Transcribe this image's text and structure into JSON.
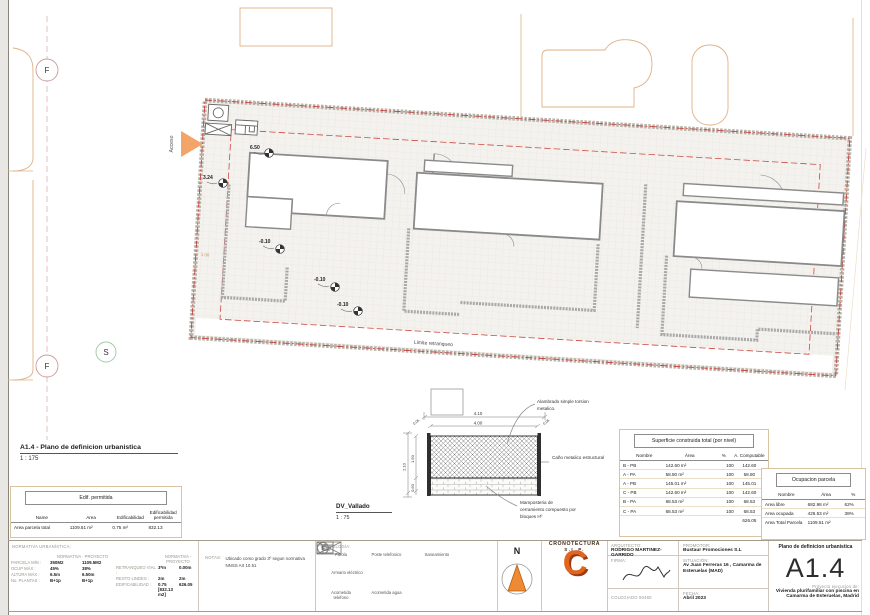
{
  "sheet": {
    "code": "A1.4",
    "plano_title": "Plano de definicion urbanistica",
    "proyecto_label": "Proyecto ejecucion de:",
    "proyecto_line1": "Vivienda plurifamiliar con piscina en",
    "proyecto_line2": "Camarma de Esteruelas, Madrid"
  },
  "view": {
    "title": "A1.4 - Plano de definicion urbanistica",
    "scale": "1 : 175"
  },
  "plan": {
    "marker_f": "F",
    "marker_f2": "F",
    "marker_s": "S",
    "acceso": "Acceso",
    "limite": "Limite retranqueo",
    "dim_left": "1.00",
    "levels": [
      "6.50",
      "3.24",
      "-0.10",
      "-0.10",
      "-0.10"
    ]
  },
  "vallado": {
    "title": "DV_Vallado",
    "scale": "1 : 75",
    "dim_total_w": "4.10",
    "dim_inner_w": "4.00",
    "dim_side_l": "0.05",
    "dim_side_r": "0.05",
    "dim_total_h": "2.10",
    "dim_mesh_h": "1.50",
    "dim_base_h": "0.60",
    "callout_mesh": "Alambrado simple torsion metalico.",
    "callout_post": "Caño metalico estructural",
    "callout_base": "Mamposteria de cerramiento compuesto por bloques Hº"
  },
  "edif_table": {
    "title": "Edif. permitida",
    "headers": [
      "Name",
      "Area",
      "Edificabilidad",
      "Edificabilidad permitida"
    ],
    "row": [
      "Area parcela total",
      "1109.51 m²",
      "0.75 m²",
      "832.13"
    ]
  },
  "superficie_table": {
    "title": "Superficie construida total (por nivel)",
    "headers": [
      "Nombre",
      "Área",
      "%",
      "A. Computable"
    ],
    "rows": [
      [
        "B - PB",
        "142.60 m²",
        "100",
        "142.60"
      ],
      [
        "A - PA",
        "58.80 m²",
        "100",
        "58.80"
      ],
      [
        "A - PB",
        "145.01 m²",
        "100",
        "145.01"
      ],
      [
        "C - PB",
        "142.60 m²",
        "100",
        "142.60"
      ],
      [
        "B - PA",
        "68.53 m²",
        "100",
        "68.53"
      ],
      [
        "C - PA",
        "68.53 m²",
        "100",
        "68.53"
      ]
    ],
    "total": "626.05"
  },
  "ocupacion_table": {
    "title": "Ocupacion parcela",
    "headers": [
      "Nombre",
      "Área",
      "%"
    ],
    "rows": [
      [
        "Area libre",
        "682.98 m²",
        "62%"
      ],
      [
        "Area ocupada",
        "426.53 m²",
        "38%"
      ],
      [
        "Area Total Parcela",
        "1109.51 m²",
        ""
      ]
    ]
  },
  "normativa": {
    "title": "NORMATIVA URBANÍSTICA:",
    "head_norm": "NORMATIVA",
    "head_sep": "-",
    "head_proy": "PROYECTO",
    "left": [
      {
        "label": "PARCELA MÍN :",
        "norm": "350M2",
        "proy": "1109.5M2"
      },
      {
        "label": "OCUP MÁX :",
        "norm": "45%",
        "proy": "38%"
      },
      {
        "label": "ALTURA MÁX :",
        "norm": "6.5m",
        "proy": "6.50m"
      },
      {
        "label": "No. PLANTAS :",
        "norm": "B+1p",
        "proy": "B+1p"
      }
    ],
    "right": [
      {
        "label": "RETRANQUEO VIAL :",
        "norm": "3*m",
        "proy": "0.00m"
      },
      {
        "label": "RESTO LINDES :",
        "norm": "2m",
        "proy": "2m"
      },
      {
        "label": "EDIFICABILIDAD :",
        "norm": "0.75 [832.13 m2]",
        "proy": "626.05"
      }
    ]
  },
  "notas": {
    "label": "NOTAS:",
    "text": "Ubicado como grado 3º segun normativa NNSS  Art 10.51"
  },
  "simbologia": {
    "title": "SIMBOLOGÍA:",
    "items": [
      {
        "glyph": "F",
        "label": "Farola"
      },
      {
        "glyph": "T",
        "label": "Poste telefonico"
      },
      {
        "glyph": "S",
        "label": "Saneamiento"
      },
      {
        "glyph": "",
        "label": "Armario eléctrico"
      },
      {
        "glyph": "",
        "label": "Acometida telefono"
      },
      {
        "glyph": "",
        "label": "Acometida agua"
      }
    ]
  },
  "north": {
    "label": "N"
  },
  "logo": {
    "initial": "C",
    "name": "CRONOTECTURA",
    "suffix": "S.L.P."
  },
  "credits": {
    "arquitecto_label": "ARQUITECTO:",
    "arquitecto": "RODRIGO MARTINEZ-GARRIDO",
    "firma_label": "FIRMA:",
    "colegiado": "COLEGIADO 90460",
    "promotor_label": "PROMOTOR:",
    "promotor": "Bustaur Promociones S.L",
    "situacion_label": "SITUACIÓN:",
    "situacion": "Av Juan Ferreras 16 , Camarma de Esteruelas (MAD)",
    "fecha_label": "FECHA:",
    "fecha": "Abril 2023"
  },
  "colors": {
    "accent": "#e2641e",
    "setback_red": "#cf4741",
    "context": "#dcb184"
  }
}
